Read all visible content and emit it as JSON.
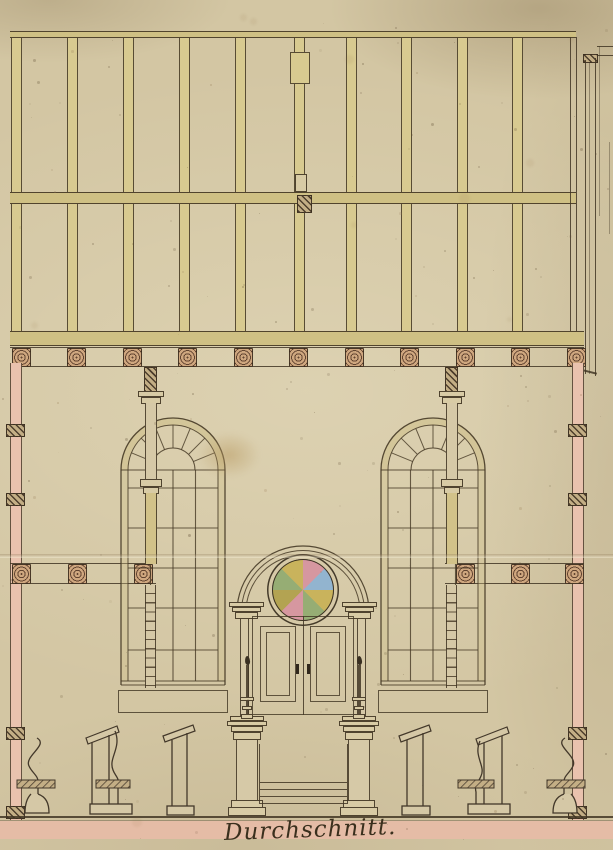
{
  "document": {
    "caption": "Durchschnitt.",
    "drawing_type": "hand-drawn architectural cross-section, ink with watercolor wash on aged paper"
  },
  "palette": {
    "paper": "#d3c6a3",
    "ink": "#4a3c28",
    "timber_wash": "#d8ca90",
    "timber_band": "#cfc084",
    "wall_pink": "#e9c2ae",
    "floor_pink": "#e5bca6",
    "joist_wood": "#cfa77f",
    "hatch_dark": "#5a4a36"
  },
  "roof_truss": {
    "post_xs": [
      11,
      67,
      123,
      179,
      235,
      294,
      346,
      401,
      457,
      512
    ],
    "post_width": 11,
    "post_top": 37,
    "post_height": 294,
    "frame": {
      "left": 10,
      "right": 576,
      "rail_y": 31,
      "tie_y": 192,
      "chord_y": 331
    }
  },
  "joist_row": {
    "y": 348,
    "block_size": 19,
    "xs": [
      12,
      67,
      123,
      178,
      234,
      289,
      345,
      400,
      456,
      511,
      567
    ]
  },
  "walls": {
    "left_x": 10,
    "right_x": 572,
    "width": 12,
    "top_y": 363,
    "height": 457,
    "tie_ys": [
      424,
      493,
      727,
      806
    ]
  },
  "gallery": {
    "band_top": 563,
    "band_bottom": 583,
    "left_spiral_xs": [
      12,
      68,
      134
    ],
    "right_spiral_xs": [
      456,
      511,
      565
    ]
  },
  "windows": {
    "x_positions": [
      118,
      378
    ],
    "top_y": 413,
    "width": 110,
    "arch_radius": 52,
    "inner_radius": 45,
    "hub_radius": 22,
    "fan_spokes": 7,
    "mullion_xs": [
      32.5,
      55,
      77.5
    ],
    "row_ys": [
      75,
      115,
      155,
      195,
      237
    ],
    "bottom_local_y": 268,
    "sill_panel": {
      "y": 690,
      "height": 23
    }
  },
  "columns": {
    "center_xs": [
      150.5,
      451.5
    ]
  },
  "ark": {
    "center_x": 303,
    "arch_radii": [
      66,
      61.5,
      57
    ],
    "rose_wedge_colors": [
      "#d697a0",
      "#92b4cf",
      "#c9b35c",
      "#96ad74",
      "#d697a0",
      "#b3a352",
      "#96ad74",
      "#c9b35c"
    ],
    "candle_xs": [
      247,
      359
    ]
  },
  "floor": {
    "line_y": 816,
    "band_y": 821,
    "band_h": 18
  }
}
